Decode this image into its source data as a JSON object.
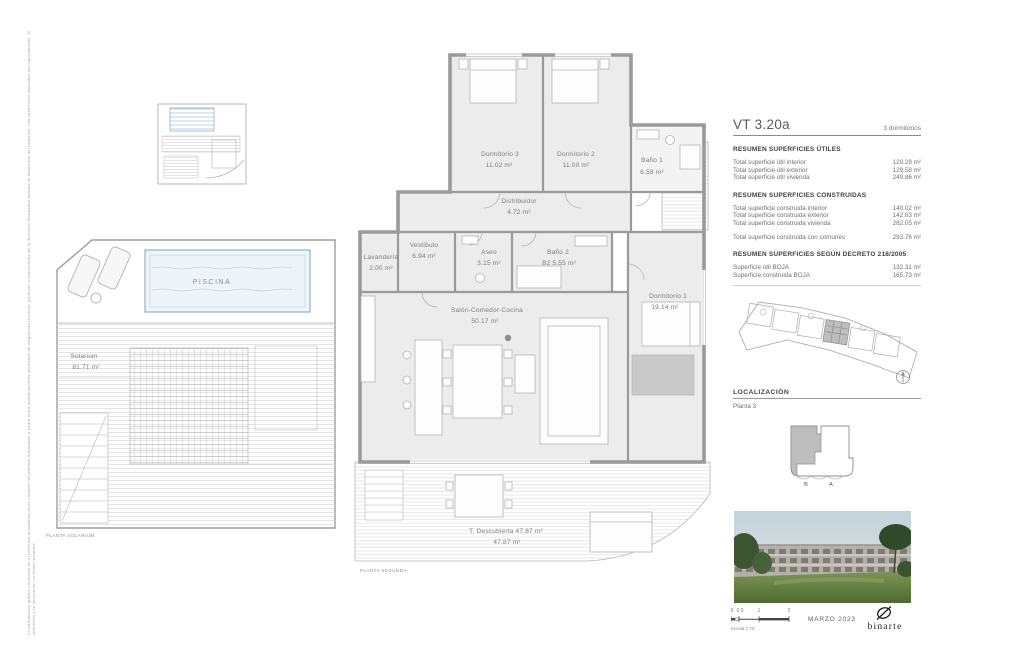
{
  "sheet": {
    "side_disclaimer": "La información gráfica contenida en el presente documento tiene carácter meramente orientativo y podrá sufrir modificaciones derivadas de exigencias técnicas, jurídicas o comerciales de la dirección facultativa durante el desarrollo del proyecto. Las superficies indicadas son aproximadas. El mobiliario y la decoración no están incluidos.",
    "planta_solarium": "PLANTA SOLARIUM",
    "planta_segunda": "PLANTA SEGUNDA"
  },
  "solarium": {
    "piscina": "PISCINA",
    "name": "Solarium",
    "area": "81.71 m²"
  },
  "floor_plan": {
    "rooms": [
      {
        "name": "Dormitorio 3",
        "area": "11.02 m²"
      },
      {
        "name": "Dormitorio 2",
        "area": "11.00 m²"
      },
      {
        "name": "Baño 1",
        "area": "6.58 m²"
      },
      {
        "name": "Distribuidor",
        "area": "4.72 m²"
      },
      {
        "name": "Vestíbulo",
        "area": "6.94 m²"
      },
      {
        "name": "Lavandería",
        "area": "2.00 m²"
      },
      {
        "name": "Aseo",
        "area": "3.15 m²"
      },
      {
        "name": "Baño 2",
        "area": "B2 5.55 m²"
      },
      {
        "name": "Salón-Comedor-Cocina",
        "area": "50.17 m²"
      },
      {
        "name": "Dormitorio 1",
        "area": "19.14 m²"
      }
    ],
    "terrace": {
      "name": "T. Descubierta",
      "area": "47.87 m²",
      "area_line2": "47.87 m²"
    }
  },
  "panel": {
    "unit_code": "VT 3.20a",
    "unit_type": "3 dormitorios",
    "sections": [
      {
        "heading": "RESUMEN SUPERFICIES ÚTILES",
        "rows": [
          {
            "label": "Total superficie útil interior",
            "value": "120.28 m²"
          },
          {
            "label": "Total superficie útil exterior",
            "value": "129.58 m²"
          },
          {
            "label": "Total superficie útil vivienda",
            "value": "249.86 m²"
          }
        ]
      },
      {
        "heading": "RESUMEN SUPERFICIES CONSTRUIDAS",
        "rows": [
          {
            "label": "Total superficie construida interior",
            "value": "140.02 m²"
          },
          {
            "label": "Total superficie construida exterior",
            "value": "142.03 m²"
          },
          {
            "label": "Total superficie construida vivienda",
            "value": "282.05 m²"
          }
        ],
        "extra_row": {
          "label": "Total superficie construida con comunes",
          "value": "293.76 m²"
        }
      },
      {
        "heading": "RESUMEN SUPERFICIES SEGÚN DECRETO 218/2005",
        "rows": [
          {
            "label": "Superficie útil BOJA",
            "value": "132.31 m²"
          },
          {
            "label": "Superficie construida BOJA",
            "value": "165.73 m²"
          }
        ]
      }
    ],
    "localizacion": {
      "heading": "LOCALIZACIÓN",
      "floor": "Planta 3",
      "block_letters": [
        "B",
        "A"
      ]
    }
  },
  "footer": {
    "scale_ticks": [
      "0",
      "0.5",
      "1",
      "2"
    ],
    "scale_text": "escala 1:75",
    "date": "MARZO 2023",
    "logo_text": "binarte"
  },
  "colors": {
    "wall_gray": "#9a9a9a",
    "room_fill": "#ececec",
    "pool_blue": "#8fb3c9",
    "highlight_gray": "#bdbdbd"
  }
}
